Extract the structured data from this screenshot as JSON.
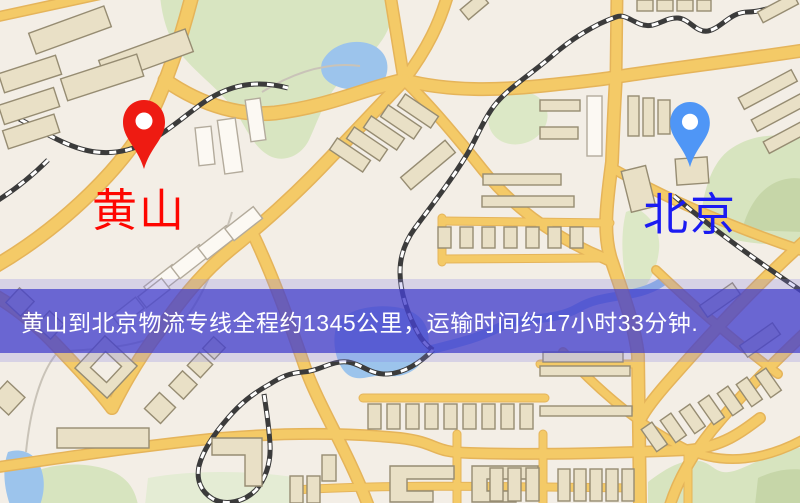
{
  "banner": {
    "text": "黄山到北京物流专线全程约1345公里，运输时间约17小时33分钟.",
    "background_color": "#4a46cf",
    "text_color": "#ffffff"
  },
  "route": {
    "origin": "黄山",
    "destination": "北京",
    "distance_km": "1345",
    "duration": "17小时33分钟"
  },
  "map": {
    "markers": [
      {
        "name": "huangshan",
        "label": "黄山",
        "pin_color": "#ee1b12",
        "label_color": "#fe0600"
      },
      {
        "name": "beijing",
        "label": "北京",
        "pin_color": "#4f96f6",
        "label_color": "#1b1bf2"
      }
    ],
    "colors": {
      "background": "#f3eee6",
      "road": "#f4ca67",
      "park": "#d8e5c1",
      "water": "#9cc4ec",
      "building": "#e9e0c6",
      "railway": "#3b3b3b"
    }
  }
}
